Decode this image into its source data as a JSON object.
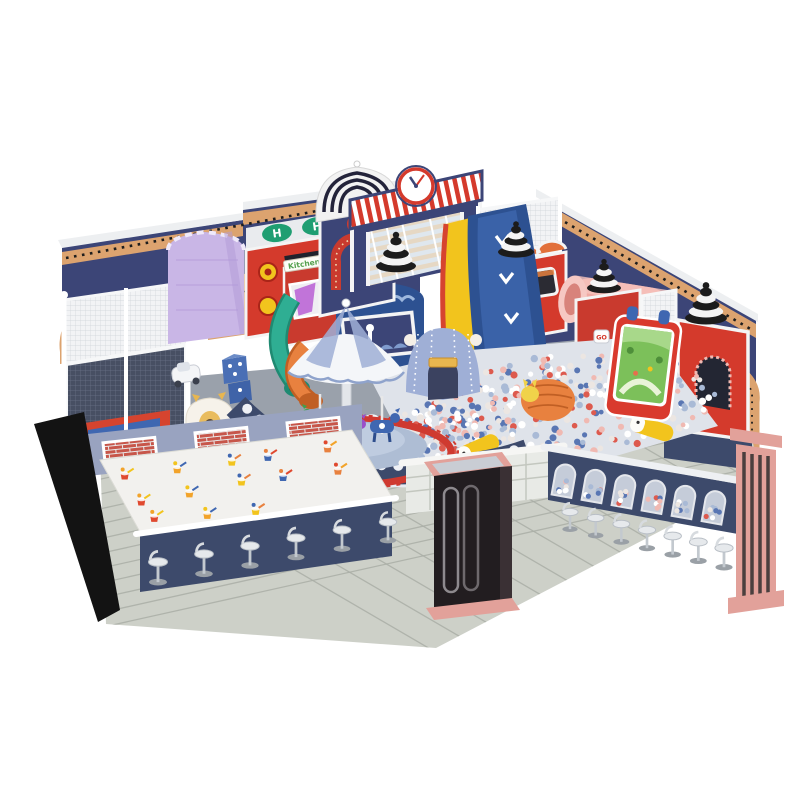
{
  "scene": {
    "description": "3D product render of a circus-themed indoor soft-play playground: navy arched walls, clock-tower gate, wave slides into a ball pit, carousel, sand table and snack counters with bar stools",
    "background": "#ffffff",
    "signs": {
      "kitchen": "Kitchen",
      "go": "GO",
      "helipad_left": "H",
      "helipad_right": "H"
    },
    "clock": {
      "time": "10:09"
    },
    "palette": {
      "wall_navy": "#3c4577",
      "wall_navy_dark": "#303963",
      "wall_cap": "#edeff1",
      "arch_tan": "#dca36f",
      "arch_dot": "#1d1d1d",
      "red": "#d43a2c",
      "red_dark": "#a92518",
      "blue_slide": "#2d5191",
      "blue_slide_light": "#3a62a8",
      "yellow": "#f2c41d",
      "teal": "#2fae93",
      "orange": "#e8813f",
      "pink_tube": "#efa9a3",
      "pink_column": "#e2a19a",
      "lavender": "#c9b6e6",
      "periwinkle": "#9fafd6",
      "navy_base": "#3d4a6b",
      "floor_tile": "#cdd0c8",
      "floor_grout": "#aaaea6",
      "play_floor": "#9aa1ab",
      "white": "#ffffff",
      "chrome": "#c3c9cf",
      "screen_green": "#7cc05a",
      "kiosk_dark": "#221d20",
      "carousel_ring": "#cf3a30"
    },
    "ball_pit": {
      "count": 430,
      "colors": [
        "#dd5a4e",
        "#ffffff",
        "#a9bad6",
        "#f0b9b2",
        "#5976b3",
        "#ece6e2"
      ]
    },
    "counters": {
      "stools_left": 6,
      "stools_right": 7,
      "ball_window_arches": 6
    },
    "sand_table": {
      "toy_count": 13,
      "toy_colors": [
        "#e0492f",
        "#f2a32a",
        "#f2c41d",
        "#3f67b1",
        "#e8813f"
      ]
    },
    "floor": {
      "dot_count": 16
    },
    "elements": [
      "clock-tower-gate",
      "ribbed-dome-tower",
      "wave-slides",
      "ball-pit",
      "carousel",
      "parachute-canopy",
      "circus-tent",
      "train-playhouse",
      "pink-crawl-tube",
      "interactive-projection-screen",
      "striped-beehive-domes",
      "trampoline-cage",
      "purple-tower",
      "helipad-house",
      "kitchen-house",
      "tube-slides",
      "sand-play-table",
      "snack-counters-with-stools",
      "entrance-kiosk",
      "pink-column",
      "arched-circus-walls"
    ]
  }
}
